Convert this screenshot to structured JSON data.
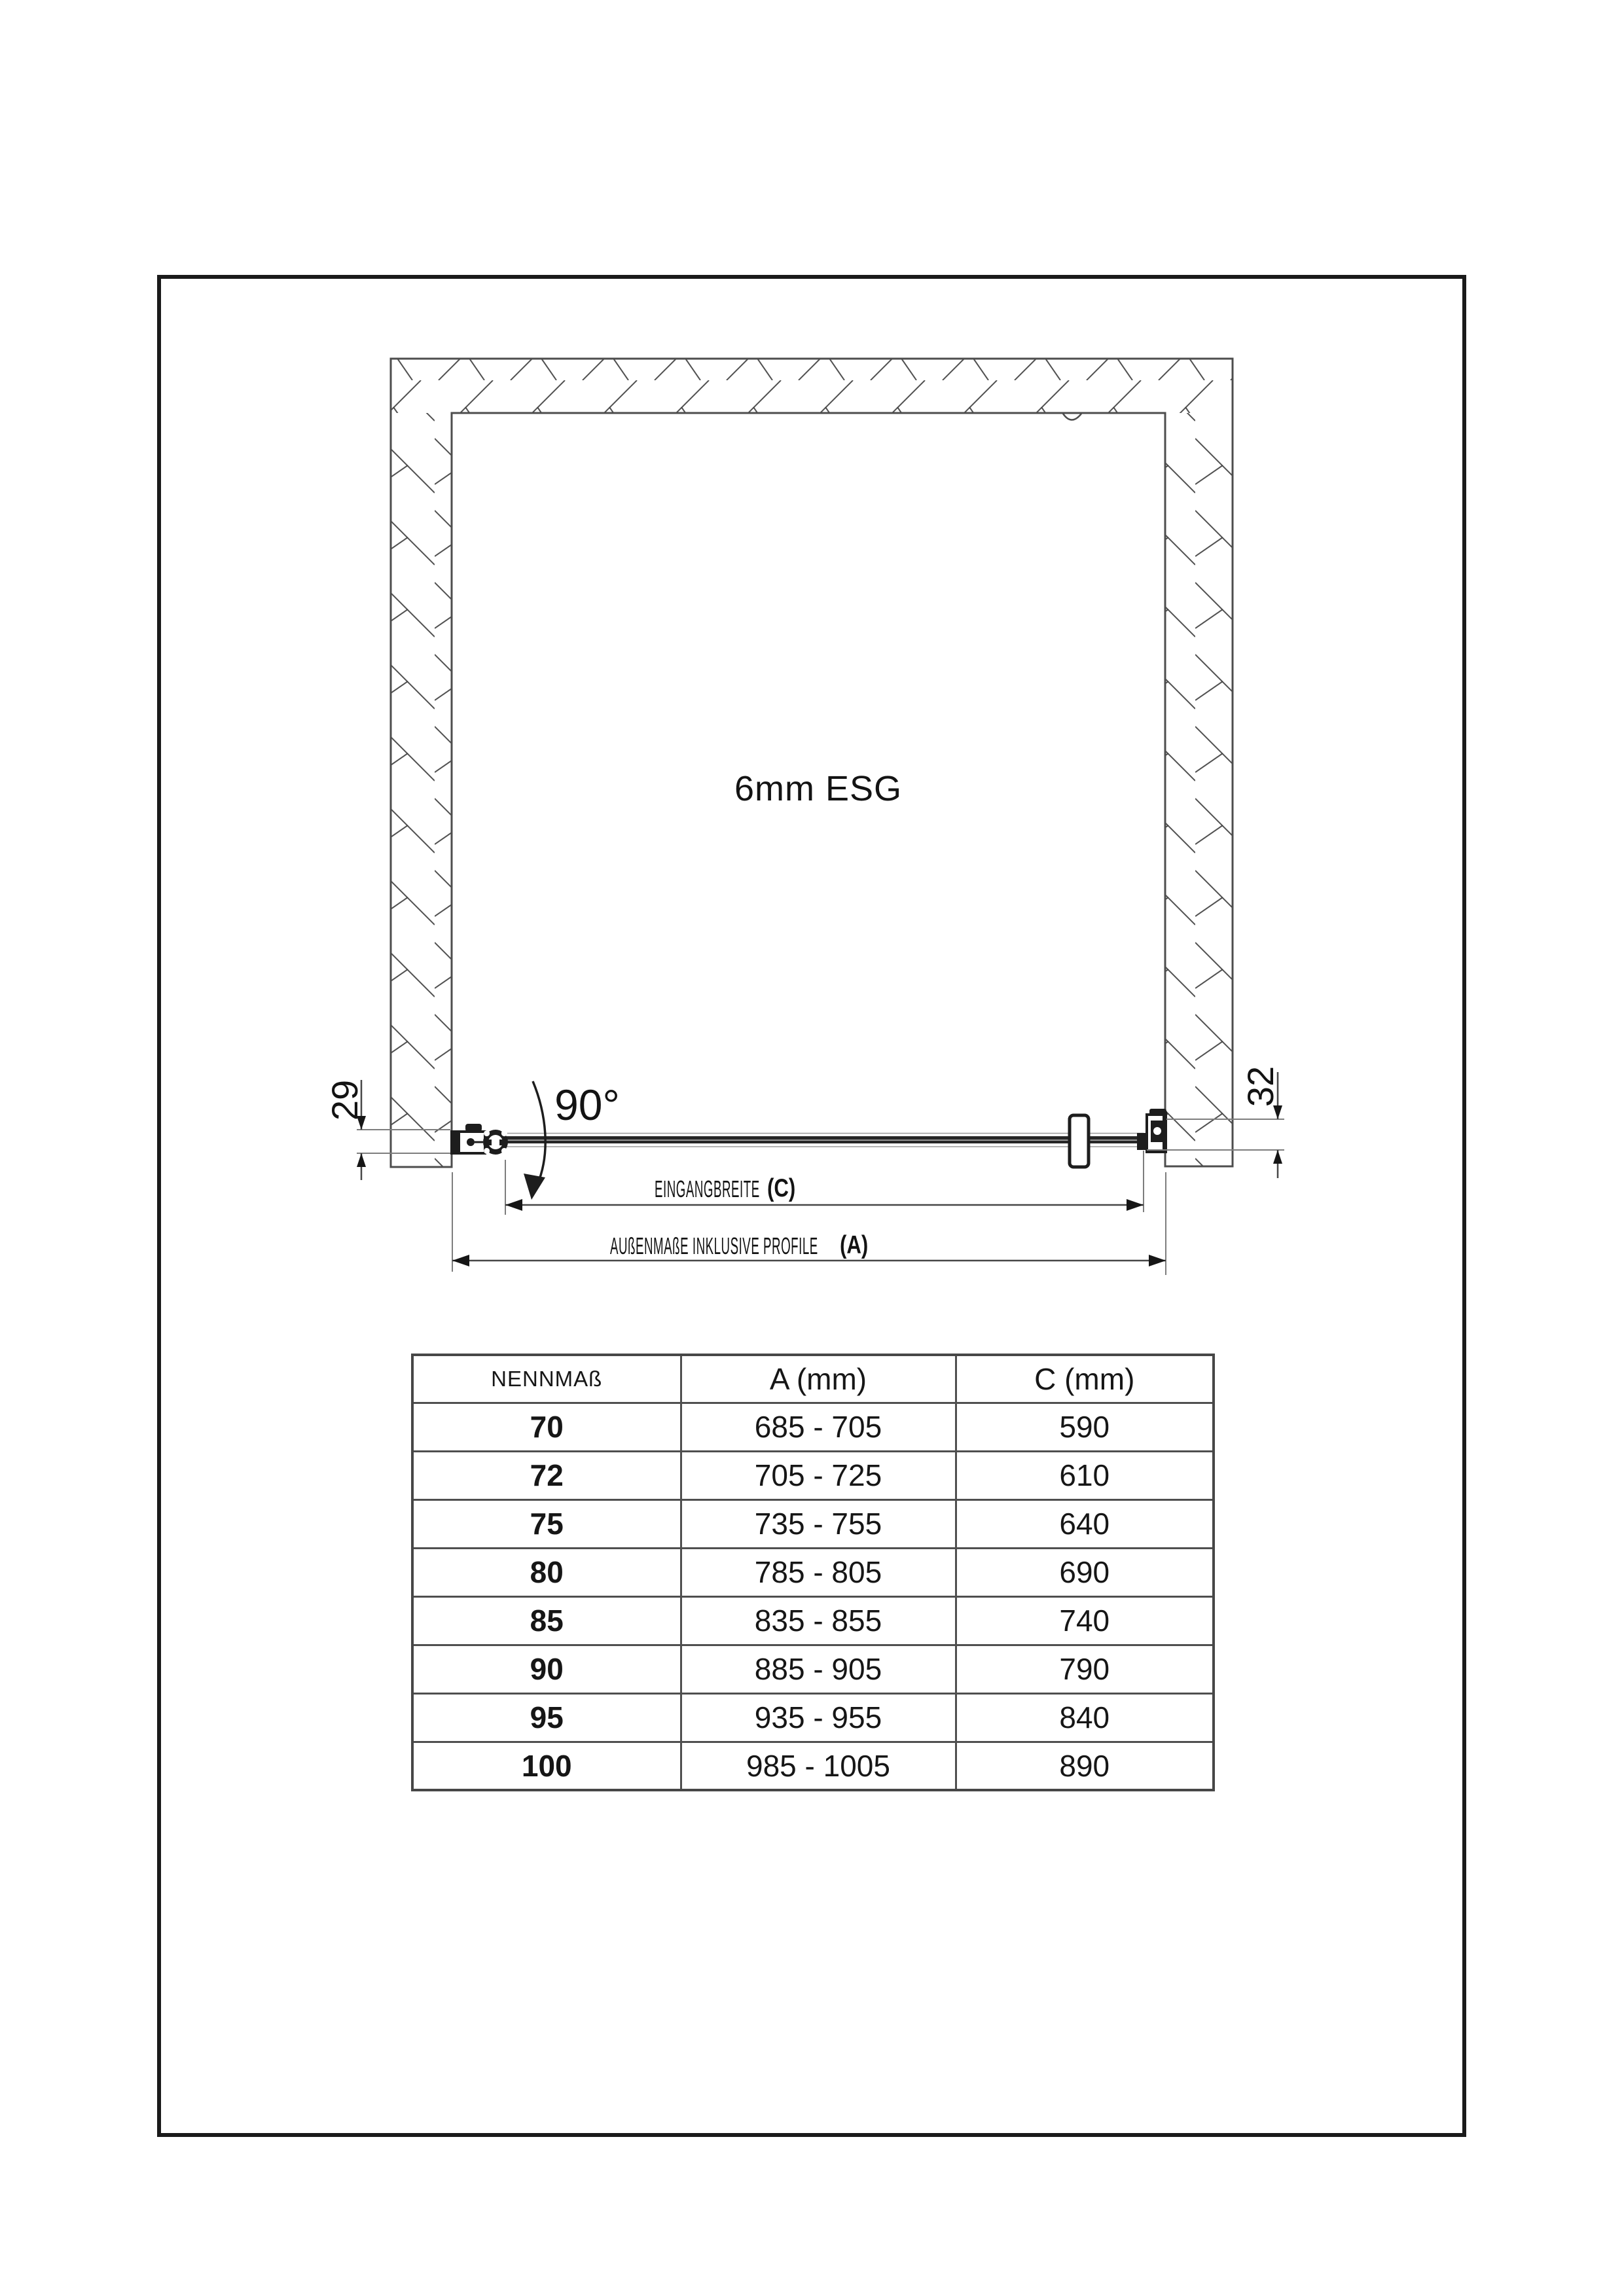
{
  "diagram": {
    "glass_label": "6mm ESG",
    "swing_angle_label": "90°",
    "left_profile_dim": "29",
    "right_profile_dim": "32",
    "entry_width_label": "EINGANGBREITE",
    "entry_width_ref": "(C)",
    "outer_width_label": "AUßENMAßE INKLUSIVE PROFILE",
    "outer_width_ref": "(A)"
  },
  "table": {
    "headers": [
      "NENNMAß",
      "A (mm)",
      "C (mm)"
    ],
    "rows": [
      {
        "nennmass": "70",
        "a_mm": "685 - 705",
        "c_mm": "590"
      },
      {
        "nennmass": "72",
        "a_mm": "705 - 725",
        "c_mm": "610"
      },
      {
        "nennmass": "75",
        "a_mm": "735 - 755",
        "c_mm": "640"
      },
      {
        "nennmass": "80",
        "a_mm": "785 - 805",
        "c_mm": "690"
      },
      {
        "nennmass": "85",
        "a_mm": "835 - 855",
        "c_mm": "740"
      },
      {
        "nennmass": "90",
        "a_mm": "885 - 905",
        "c_mm": "790"
      },
      {
        "nennmass": "95",
        "a_mm": "935 - 955",
        "c_mm": "840"
      },
      {
        "nennmass": "100",
        "a_mm": "985 - 1005",
        "c_mm": "890"
      }
    ]
  },
  "colors": {
    "line": "#4d4d4d",
    "dark": "#1d1d1d",
    "extension_line": "#7d7d7d",
    "table_border": "#4f4f4f"
  }
}
